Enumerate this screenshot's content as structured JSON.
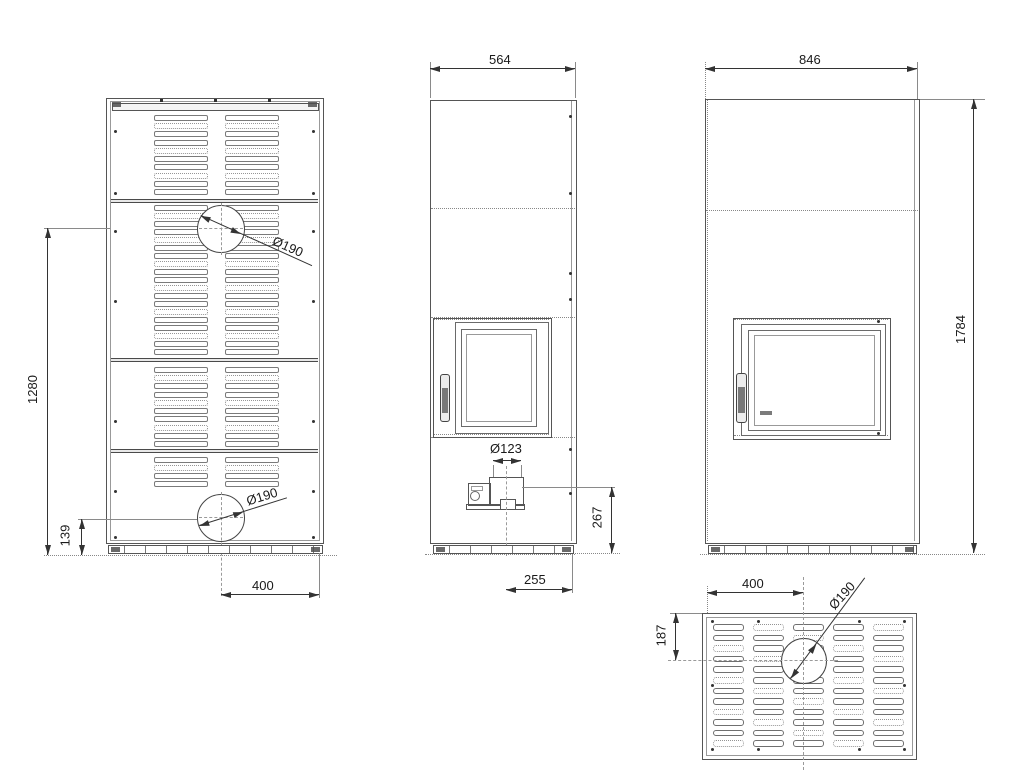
{
  "drawing": {
    "type": "technical-dimension-drawing",
    "subject": "freestanding stove / fireplace, four orthographic views (rear, side, front, top)",
    "colors": {
      "background": "#ffffff",
      "lines": "#4a4a4a",
      "dimension_text": "#1a1a1a"
    },
    "dims": {
      "rear_height": "1280",
      "rear_flue_offset_bottom": "139",
      "rear_flue_offset_x": "400",
      "rear_flue_dia": "Ø190",
      "rear_flue_dia_bottom": "Ø190",
      "side_depth": "564",
      "side_inlet_dia": "Ø123",
      "side_inlet_height": "267",
      "side_inlet_offset": "255",
      "front_width": "846",
      "front_height": "1784",
      "top_flue_offset_x": "400",
      "top_flue_offset_y": "187",
      "top_flue_dia": "Ø190"
    }
  }
}
